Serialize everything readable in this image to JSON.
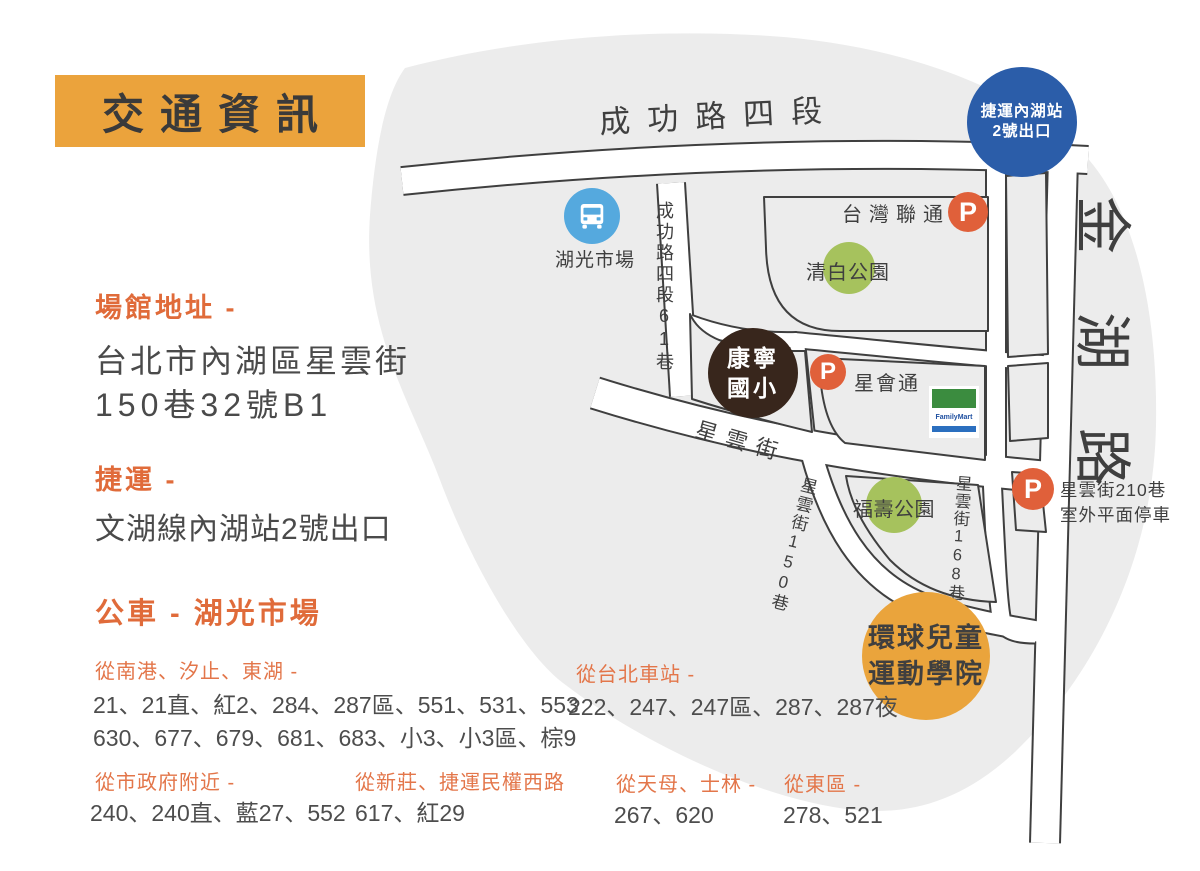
{
  "title": "交通資訊",
  "info": {
    "address": {
      "heading": "場館地址 -",
      "line1": "台北市內湖區星雲街",
      "line2": "150巷32號B1"
    },
    "mrt": {
      "heading": "捷運 -",
      "detail": "文湖線內湖站2號出口"
    },
    "bus": {
      "heading": "公車 - 湖光市場",
      "groups": [
        {
          "from": "從南港、汐止、東湖 -",
          "routes": "21、21直、紅2、284、287區、551、531、553",
          "routes2": "630、677、679、681、683、小3、小3區、棕9"
        },
        {
          "from": "從台北車站 -",
          "routes": "222、247、247區、287、287夜"
        },
        {
          "from": "從市政府附近 -",
          "routes": "240、240直、藍27、552"
        },
        {
          "from": "從新莊、捷運民權西路",
          "routes": "617、紅29"
        },
        {
          "from": "從天母、士林 -",
          "routes": "267、620"
        },
        {
          "from": "從東區 -",
          "routes": "278、521"
        }
      ]
    }
  },
  "map": {
    "roads": {
      "chenggong": "成功路四段",
      "chenggong61": "成功路四段61巷",
      "jinhu": "金湖路",
      "xingyun": "星雲街",
      "xingyun150": "星雲街150巷",
      "xingyun168": "星雲街168巷"
    },
    "landmarks": {
      "p_label": "P",
      "mrt_exit": {
        "line1": "捷運內湖站",
        "line2": "2號出口"
      },
      "bus_stop": "湖光市場",
      "taiwan_liantong": "台灣聯通",
      "qingbai_park": "清白公園",
      "kangning_school": {
        "line1": "康寧",
        "line2": "國小"
      },
      "xinghuitong": "星會通",
      "familymart": "FamilyMart",
      "fushou_park": "福壽公園",
      "parking_210": {
        "line1": "星雲街210巷",
        "line2": "室外平面停車"
      },
      "sports_academy": {
        "line1": "環球兒童",
        "line2": "運動學院"
      }
    }
  },
  "colors": {
    "accent_orange": "#E06B3A",
    "banner_orange": "#EBA33C",
    "academy_orange": "#EAA43C",
    "parking_orange": "#E0603A",
    "mrt_blue": "#2B5DA9",
    "bus_blue": "#55A9DE",
    "park_green": "#A6C25D",
    "school_brown": "#38261C",
    "familymart_green": "#3B8C3F",
    "familymart_blue": "#2B6FBF",
    "map_gray": "#ECECEC",
    "line_dark": "#3F3F3F"
  }
}
